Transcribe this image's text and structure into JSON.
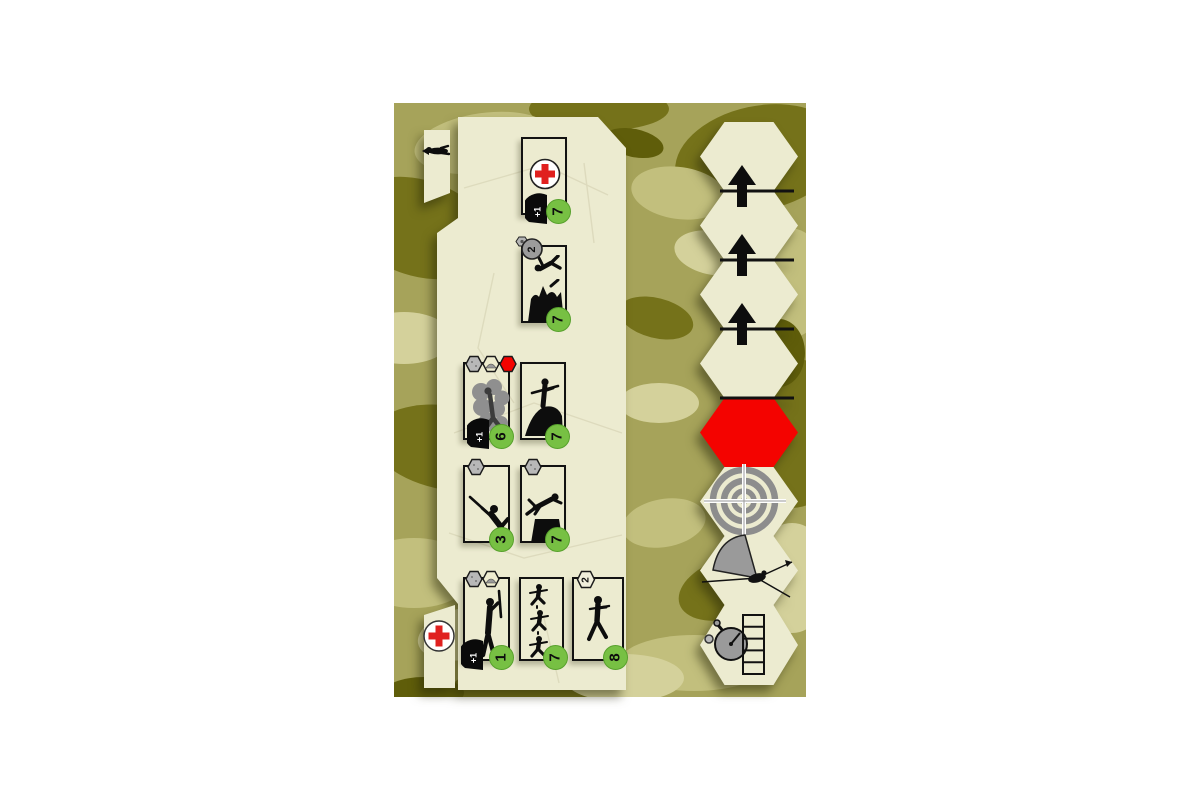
{
  "colors": {
    "page_bg": "#ffffff",
    "camo_base": "#a6a35a",
    "camo_dark": "#75721a",
    "camo_darkest": "#5f5d0a",
    "camo_light": "#d4d19b",
    "camo_mid": "#c2bf7d",
    "panel_bg": "#ecebd0",
    "card_border": "#121212",
    "badge_green": "#77c043",
    "alert_red": "#f40300",
    "medic_cross_red": "#e0201f",
    "marker_gray": "#9a9a9a",
    "silhouette_black": "#0d0d0d"
  },
  "panel": {
    "tabs": [
      {
        "name": "crawling-soldier-tab",
        "icon": "crawling-soldier-icon"
      },
      {
        "name": "medic-tab",
        "icon": "medic-cross-icon"
      }
    ],
    "cards": [
      {
        "name": "medic-card",
        "icons": [
          "medic-cross-icon",
          "helmet-icon"
        ],
        "helmet_bonus": "+1",
        "badge": "7"
      },
      {
        "name": "mortar-blast-card",
        "icons": [
          "timer-icon",
          "falling-soldier-icon",
          "mortar-blast-icon"
        ],
        "timer_value": "2",
        "badge": "7"
      },
      {
        "name": "smoke-card",
        "top_markers": [
          "gray-hex-icon",
          "mound-hex-icon",
          "red-hex-icon"
        ],
        "icons": [
          "smoke-cloud-icon",
          "helmet-icon"
        ],
        "helmet_bonus": "+1",
        "badge": "6"
      },
      {
        "name": "mound-assault-card",
        "icons": [
          "soldier-on-mound-icon"
        ],
        "badge": "7"
      },
      {
        "name": "reclining-shooter-card",
        "top_markers": [
          "gray-hex-icon"
        ],
        "icons": [
          "reclining-shooter-icon"
        ],
        "badge": "3"
      },
      {
        "name": "wall-vault-card",
        "top_markers": [
          "gray-hex-icon"
        ],
        "icons": [
          "wall-climber-icon"
        ],
        "badge": "7"
      },
      {
        "name": "standing-shooter-card",
        "top_markers": [
          "gray-hex-icon",
          "mound-hex-icon"
        ],
        "icons": [
          "standing-shooter-icon",
          "helmet-icon"
        ],
        "helmet_bonus": "+1",
        "badge": "1"
      },
      {
        "name": "squad-march-card",
        "icons": [
          "three-walking-soldiers-icon"
        ],
        "badge": "7"
      },
      {
        "name": "lone-walker-card",
        "top_markers": [
          "value-hex-icon"
        ],
        "hex_value": "2",
        "icons": [
          "walking-soldier-icon"
        ],
        "badge": "8"
      }
    ]
  },
  "hex_column": {
    "plain_hex_count": 4,
    "advance_arrow_count": 3,
    "special_hexes": [
      "red-alert-hex",
      "target-hex",
      "fire-arc-hex",
      "stopwatch-track-hex"
    ],
    "track_cells": 5
  }
}
